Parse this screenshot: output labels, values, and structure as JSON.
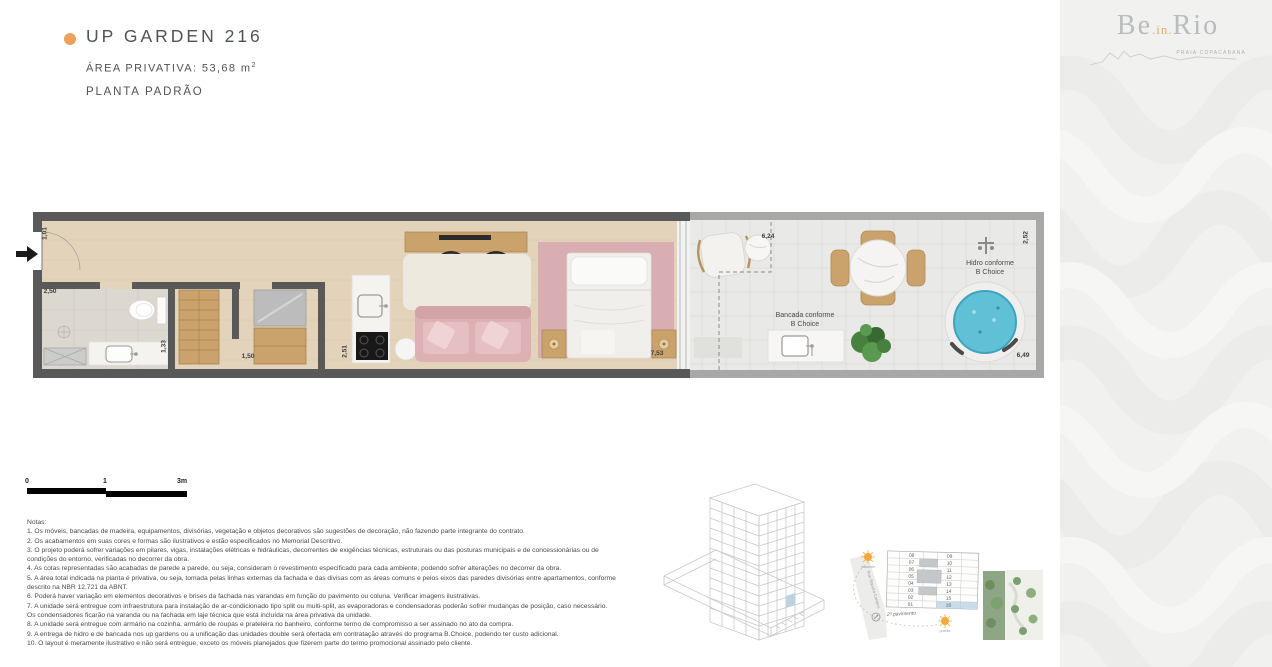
{
  "header": {
    "title": "UP GARDEN 216",
    "area_prefix": "ÁREA PRIVATIVA: 53,68 m",
    "area_sup": "2",
    "plan_type": "PLANTA PADRÃO"
  },
  "logo": {
    "part1": "Be",
    "part2": ".in.",
    "part3": "Rio",
    "tagline": "PRAIA COPACABANA"
  },
  "plan": {
    "dims": {
      "d1": "1,01",
      "d2": "2,50",
      "d3": "1,33",
      "d4": "1,50",
      "d5": "2,51",
      "d6": "7,53",
      "d7": "6,24",
      "d8": "2,52",
      "d9": "6,49"
    },
    "bancada_label_1": "Bancada conforme",
    "bancada_label_2": "B Choice",
    "hidro_label_1": "Hidro conforme",
    "hidro_label_2": "B Choice"
  },
  "scalebar": {
    "t0": "0",
    "t1": "1",
    "t2": "3m"
  },
  "notes": {
    "title": "Notas:",
    "lines": [
      "1. Os móveis, bancadas de madeira, equipamentos, divisórias, vegetação e objetos decorativos são sugestões de decoração, não fazendo parte integrante do contrato.",
      "2. Os acabamentos em suas cores e formas são ilustrativos e estão especificados no Memorial Descritivo.",
      "3. O projeto poderá sofrer variações em pilares, vigas, instalações elétricas e hidráulicas, decorrentes de exigências técnicas, estruturais ou das posturas municipais e de concessionárias ou de",
      "condições do entorno, verificadas no decorrer da obra.",
      "4. As cotas representadas são acabadas de parede a parede, ou seja, consideram o revestimento especificado para cada ambiente, podendo sofrer alterações no decorrer da obra.",
      "5. A área total indicada na planta é privativa, ou seja, tomada pelas linhas externas da fachada e das divisas com as áreas comuns e pelos eixos das paredes divisórias entre apartamentos, conforme",
      "descrito na NBR 12.721 da ABNT.",
      "6. Poderá haver variação em elementos decorativos e brises da fachada nas varandas em função do pavimento ou coluna. Verificar imagens ilustrativas.",
      "7. A unidade será entregue com infraestrutura para instalação de ar-condicionado tipo split ou multi-split, as evaporadoras e condensadoras poderão sofrer mudanças de posição, caso necessário.",
      "Os condensadores ficarão na varanda ou na fachada em laje técnica que está incluída na área privativa da unidade.",
      "8. A unidade será entregue com armário na cozinha, armário de roupas e prateleira no banheiro, conforme termo de compromisso a ser assinado no ato da compra.",
      "9. A entrega de hidro e de bancada nos up gardens ou a unificação das unidades double será ofertada em contratação através do programa B.Choice, podendo ter custo adicional.",
      "10. O layout é meramente ilustrativo e não será entregue, exceto os móveis planejados que fizerem parte do termo promocional assinado pelo cliente."
    ]
  },
  "keyplan": {
    "floor_label": "2º pavimento",
    "street_label": "Rua Siqueira Campos",
    "sun_top_label": "nascente",
    "sun_bottom_label": "poente",
    "left_units": [
      "08",
      "07",
      "06",
      "05",
      "04",
      "03",
      "02",
      "01"
    ],
    "right_units": [
      "09",
      "10",
      "11",
      "12",
      "13",
      "14",
      "15",
      "16"
    ],
    "highlighted_unit": "16"
  },
  "colors": {
    "accent_orange": "#eda15c",
    "heading_gray": "#4d5358",
    "wall_dark": "#595959",
    "wall_light": "#a7a7a5",
    "highlight_blue": "#c8dcea",
    "hidro_blue": "#5fc0d6"
  }
}
